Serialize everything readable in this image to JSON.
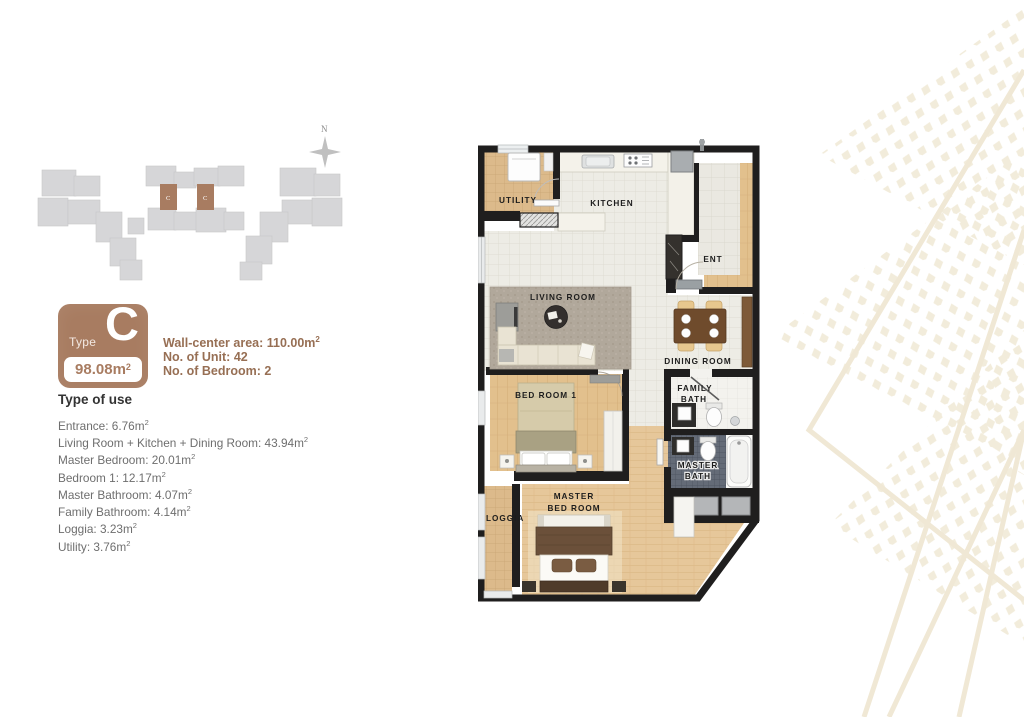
{
  "site_plan": {
    "compass_label": "N",
    "unit_marker_label": "C",
    "building_color": "#d6d6d8",
    "highlight_color": "#a87c61"
  },
  "unit_card": {
    "type_label": "Type",
    "type_letter": "C",
    "area_text": "98.08m",
    "area_sup": "2",
    "info_lines": [
      {
        "text": "Wall-center area: 110.00m",
        "sup": "2"
      },
      {
        "text": "No. of Unit: 42",
        "sup": ""
      },
      {
        "text": "No. of Bedroom: 2",
        "sup": ""
      }
    ]
  },
  "type_of_use": {
    "heading": "Type of use",
    "items": [
      {
        "text": "Entrance: 6.76m",
        "sup": "2"
      },
      {
        "text": "Living Room + Kitchen + Dining Room: 43.94m",
        "sup": "2"
      },
      {
        "text": "Master Bedroom: 20.01m",
        "sup": "2"
      },
      {
        "text": "Bedroom 1: 12.17m",
        "sup": "2"
      },
      {
        "text": "Master Bathroom: 4.07m",
        "sup": "2"
      },
      {
        "text": "Family Bathroom: 4.14m",
        "sup": "2"
      },
      {
        "text": "Loggia: 3.23m",
        "sup": "2"
      },
      {
        "text": "Utility: 3.76m",
        "sup": "2"
      }
    ]
  },
  "floor_plan": {
    "labels": {
      "utility": "UTILITY",
      "kitchen": "KITCHEN",
      "ent": "ENT",
      "living_room": "LIVING ROOM",
      "dining_room": "DINING ROOM",
      "bedroom1": "BED ROOM 1",
      "family_bath": [
        "FAMILY",
        "BATH"
      ],
      "master_bath": [
        "MASTER",
        "BATH"
      ],
      "master_bedroom": [
        "MASTER",
        "BED ROOM"
      ],
      "loggia": "LOGGIA"
    }
  },
  "colors": {
    "accent_brown": "#a87c61",
    "info_text": "#976f54",
    "wall": "#1f1e1e",
    "pattern_beige": "#f2ecdb"
  }
}
